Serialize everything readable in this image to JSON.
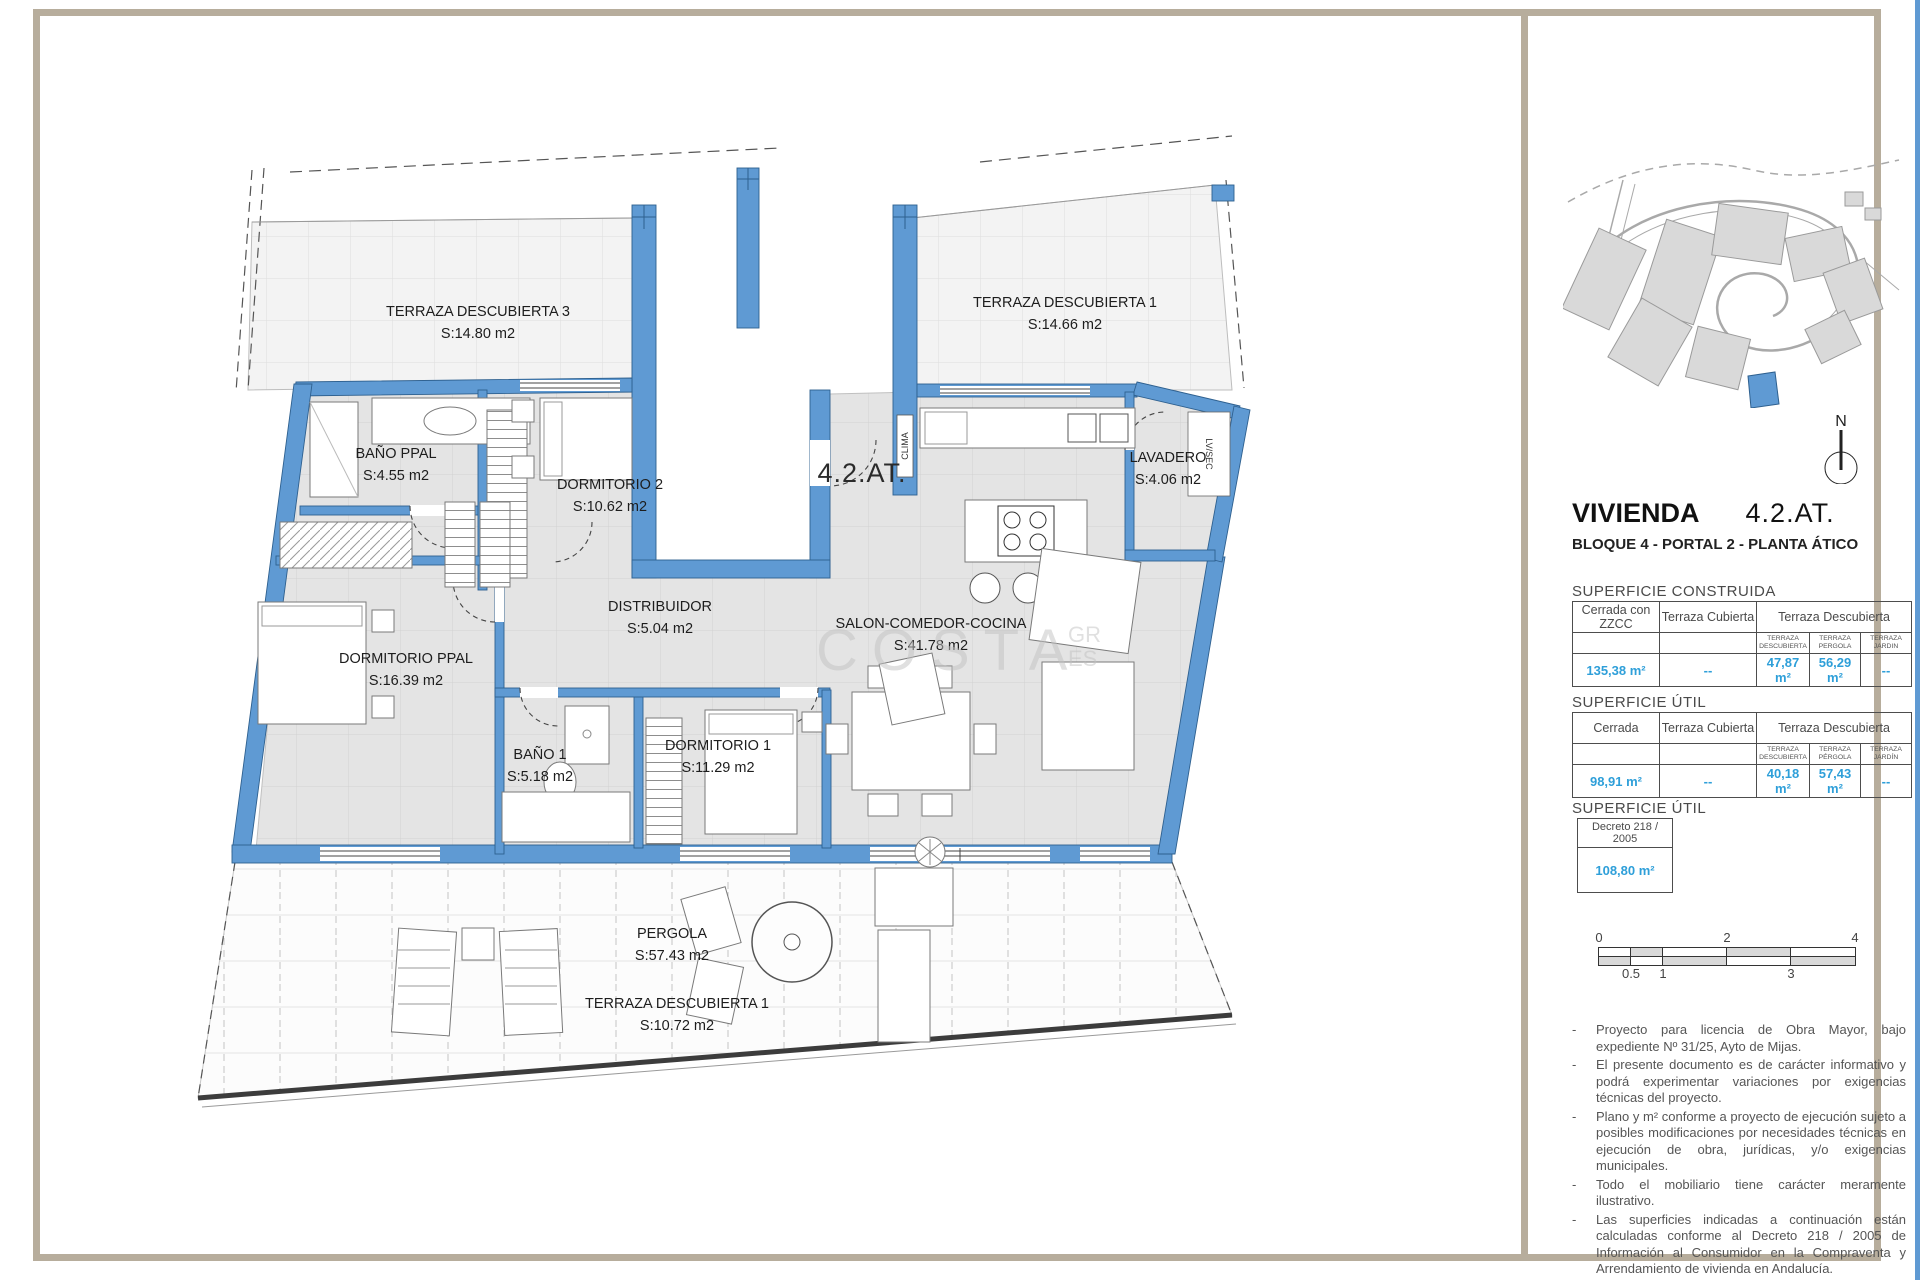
{
  "plan": {
    "unit_label": "4.2.AT.",
    "clima_label": "CLIMA",
    "lvsec_label": "LV/SEC",
    "watermark": "COSTA",
    "watermark_gr": "GR",
    "watermark_es": "ES",
    "rooms": [
      {
        "name": "TERRAZA DESCUBIERTA 3",
        "area": "S:14.80 m2"
      },
      {
        "name": "TERRAZA DESCUBIERTA 1",
        "area": "S:14.66 m2"
      },
      {
        "name": "BAÑO PPAL",
        "area": "S:4.55 m2"
      },
      {
        "name": "DORMITORIO 2",
        "area": "S:10.62 m2"
      },
      {
        "name": "LAVADERO",
        "area": "S:4.06 m2"
      },
      {
        "name": "DISTRIBUIDOR",
        "area": "S:5.04 m2"
      },
      {
        "name": "SALON-COMEDOR-COCINA",
        "area": "S:41.78 m2"
      },
      {
        "name": "DORMITORIO PPAL",
        "area": "S:16.39 m2"
      },
      {
        "name": "BAÑO 1",
        "area": "S:5.18 m2"
      },
      {
        "name": "DORMITORIO 1",
        "area": "S:11.29 m2"
      },
      {
        "name": "PERGOLA",
        "area": "S:57.43 m2"
      },
      {
        "name": "TERRAZA DESCUBIERTA 1",
        "area": "S:10.72 m2"
      }
    ]
  },
  "sidebar": {
    "north_label": "N",
    "title": "VIVIENDA",
    "title_code": "4.2.AT.",
    "subtitle": "BLOQUE 4 - PORTAL 2 - PLANTA ÁTICO",
    "construida": {
      "heading": "SUPERFICIE CONSTRUIDA",
      "col1": "Cerrada con ZZCC",
      "col2": "Terraza Cubierta",
      "col3": "Terraza Descubierta",
      "sub": [
        "TERRAZA DESCUBIERTA",
        "TERRAZA PERGOLA",
        "TERRAZA JARDIN"
      ],
      "values": [
        "135,38 m²",
        "--",
        "47,87 m²",
        "56,29 m²",
        "--"
      ]
    },
    "util": {
      "heading": "SUPERFICIE ÚTIL",
      "col1": "Cerrada",
      "col2": "Terraza Cubierta",
      "col3": "Terraza Descubierta",
      "sub": [
        "TERRAZA DESCUBIERTA",
        "TERRAZA PÉRGOLA",
        "TERRAZA JARDÍN"
      ],
      "values": [
        "98,91 m²",
        "--",
        "40,18 m²",
        "57,43 m²",
        "--"
      ]
    },
    "util2": {
      "heading": "SUPERFICIE ÚTIL",
      "header": "Decreto  218 / 2005",
      "value": "108,80 m²"
    },
    "scale": {
      "top_labels": [
        "0",
        "2",
        "4"
      ],
      "bottom_labels": [
        "0.5",
        "1",
        "3"
      ]
    },
    "notes_marker": "-",
    "notes": [
      "Proyecto para licencia de Obra Mayor, bajo expediente Nº 31/25, Ayto de Mijas.",
      "El presente documento es de carácter informativo y podrá experimentar variaciones por exigencias técnicas del proyecto.",
      "Plano y m² conforme a proyecto de ejecución sujeto a posibles modificaciones por necesidades técnicas en ejecución de obra, jurídicas, y/o exigencias municipales.",
      "Todo el mobiliario tiene carácter meramente ilustrativo.",
      "Las superficies indicadas a continuación están calculadas conforme al Decreto 218 / 2005  de Información al Consumidor en la Compraventa y Arrendamiento de vivienda en Andalucía."
    ]
  }
}
